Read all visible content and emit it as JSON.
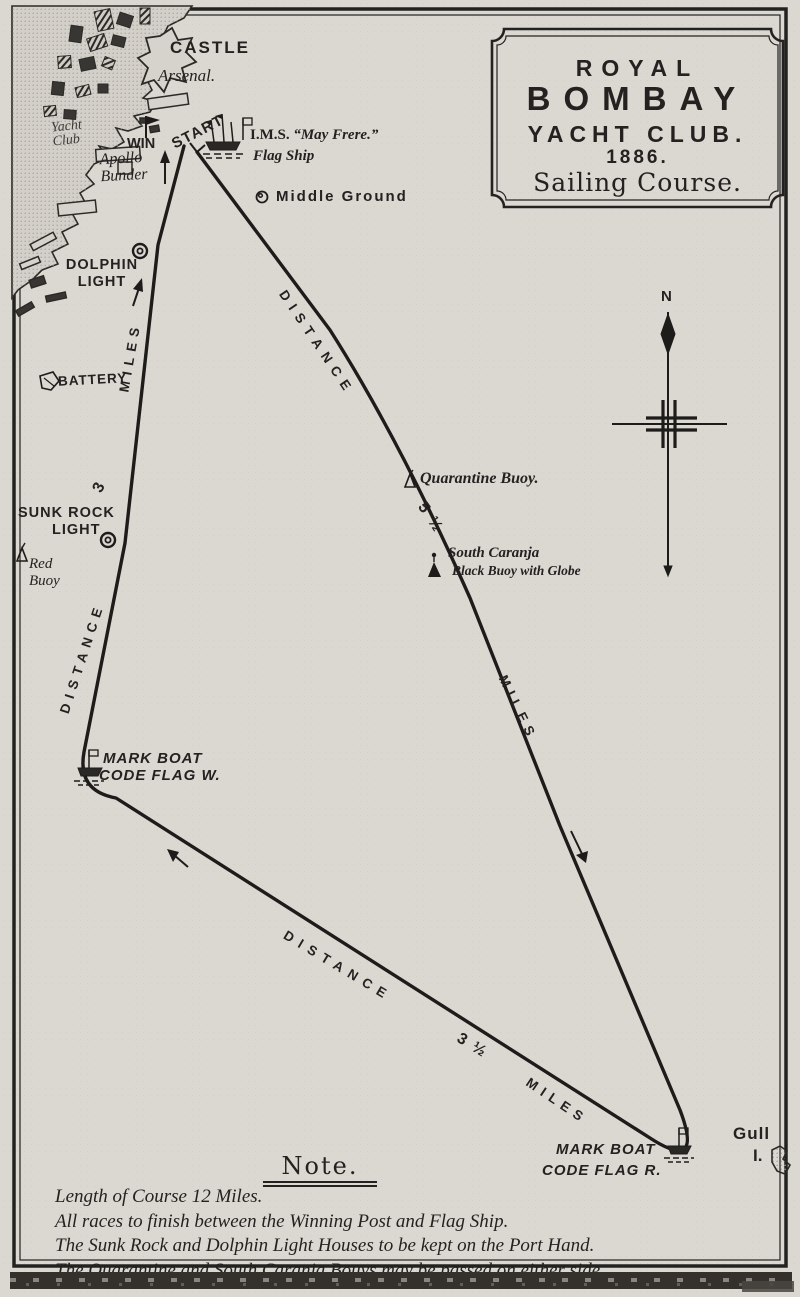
{
  "colors": {
    "paper": "#dbd8d2",
    "ink": "#232220"
  },
  "title_box": {
    "royal": "ROYAL",
    "bombay": "BOMBAY",
    "yacht_club": "YACHT CLUB.",
    "year": "1886.",
    "subtitle": "Sailing Course."
  },
  "compass": {
    "north": "N"
  },
  "shore": {
    "castle": "CASTLE",
    "arsenal": "Arsenal.",
    "yacht_club": "Yacht\nClub",
    "win": "WIN",
    "start": "START",
    "apollo_bunder": "Apollo\nBunder",
    "flag_ship_prefix": "I.M.S.",
    "flag_ship_name": "“May Frere.”",
    "flag_ship_caption": "Flag Ship",
    "middle_ground": "Middle Ground",
    "dolphin_light": "DOLPHIN\nLIGHT",
    "battery": "BATTERY",
    "sunk_rock_light": "SUNK ROCK",
    "sunk_rock_light_2": "LIGHT",
    "red_buoy": "Red\nBuoy"
  },
  "marks": {
    "quarantine_buoy": "Quarantine Buoy.",
    "south_caranja": "South Caranja",
    "south_caranja_2": "Black Buoy with Globe",
    "mark_boat_w_1": "MARK BOAT",
    "mark_boat_w_2": "CODE FLAG W.",
    "mark_boat_r_1": "MARK BOAT",
    "mark_boat_r_2": "CODE FLAG R.",
    "gull_1": "Gull",
    "gull_2": "I."
  },
  "legs": {
    "finish": {
      "word": "DISTANCE",
      "value": "3",
      "miles": "MILES"
    },
    "outward": {
      "word": "DISTANCE",
      "value": "5 ½",
      "miles": "MILES"
    },
    "bottom": {
      "word": "DISTANCE",
      "value": "3 ½",
      "miles": "MILES"
    }
  },
  "note": {
    "heading": "Note.",
    "lines": [
      "Length of Course 12 Miles.",
      "All races to finish between the Winning Post and Flag Ship.",
      "The Sunk Rock and Dolphin Light Houses to be kept on the Port Hand.",
      "The Quarantine and South Caranja Bouys may be passed on either side."
    ]
  }
}
